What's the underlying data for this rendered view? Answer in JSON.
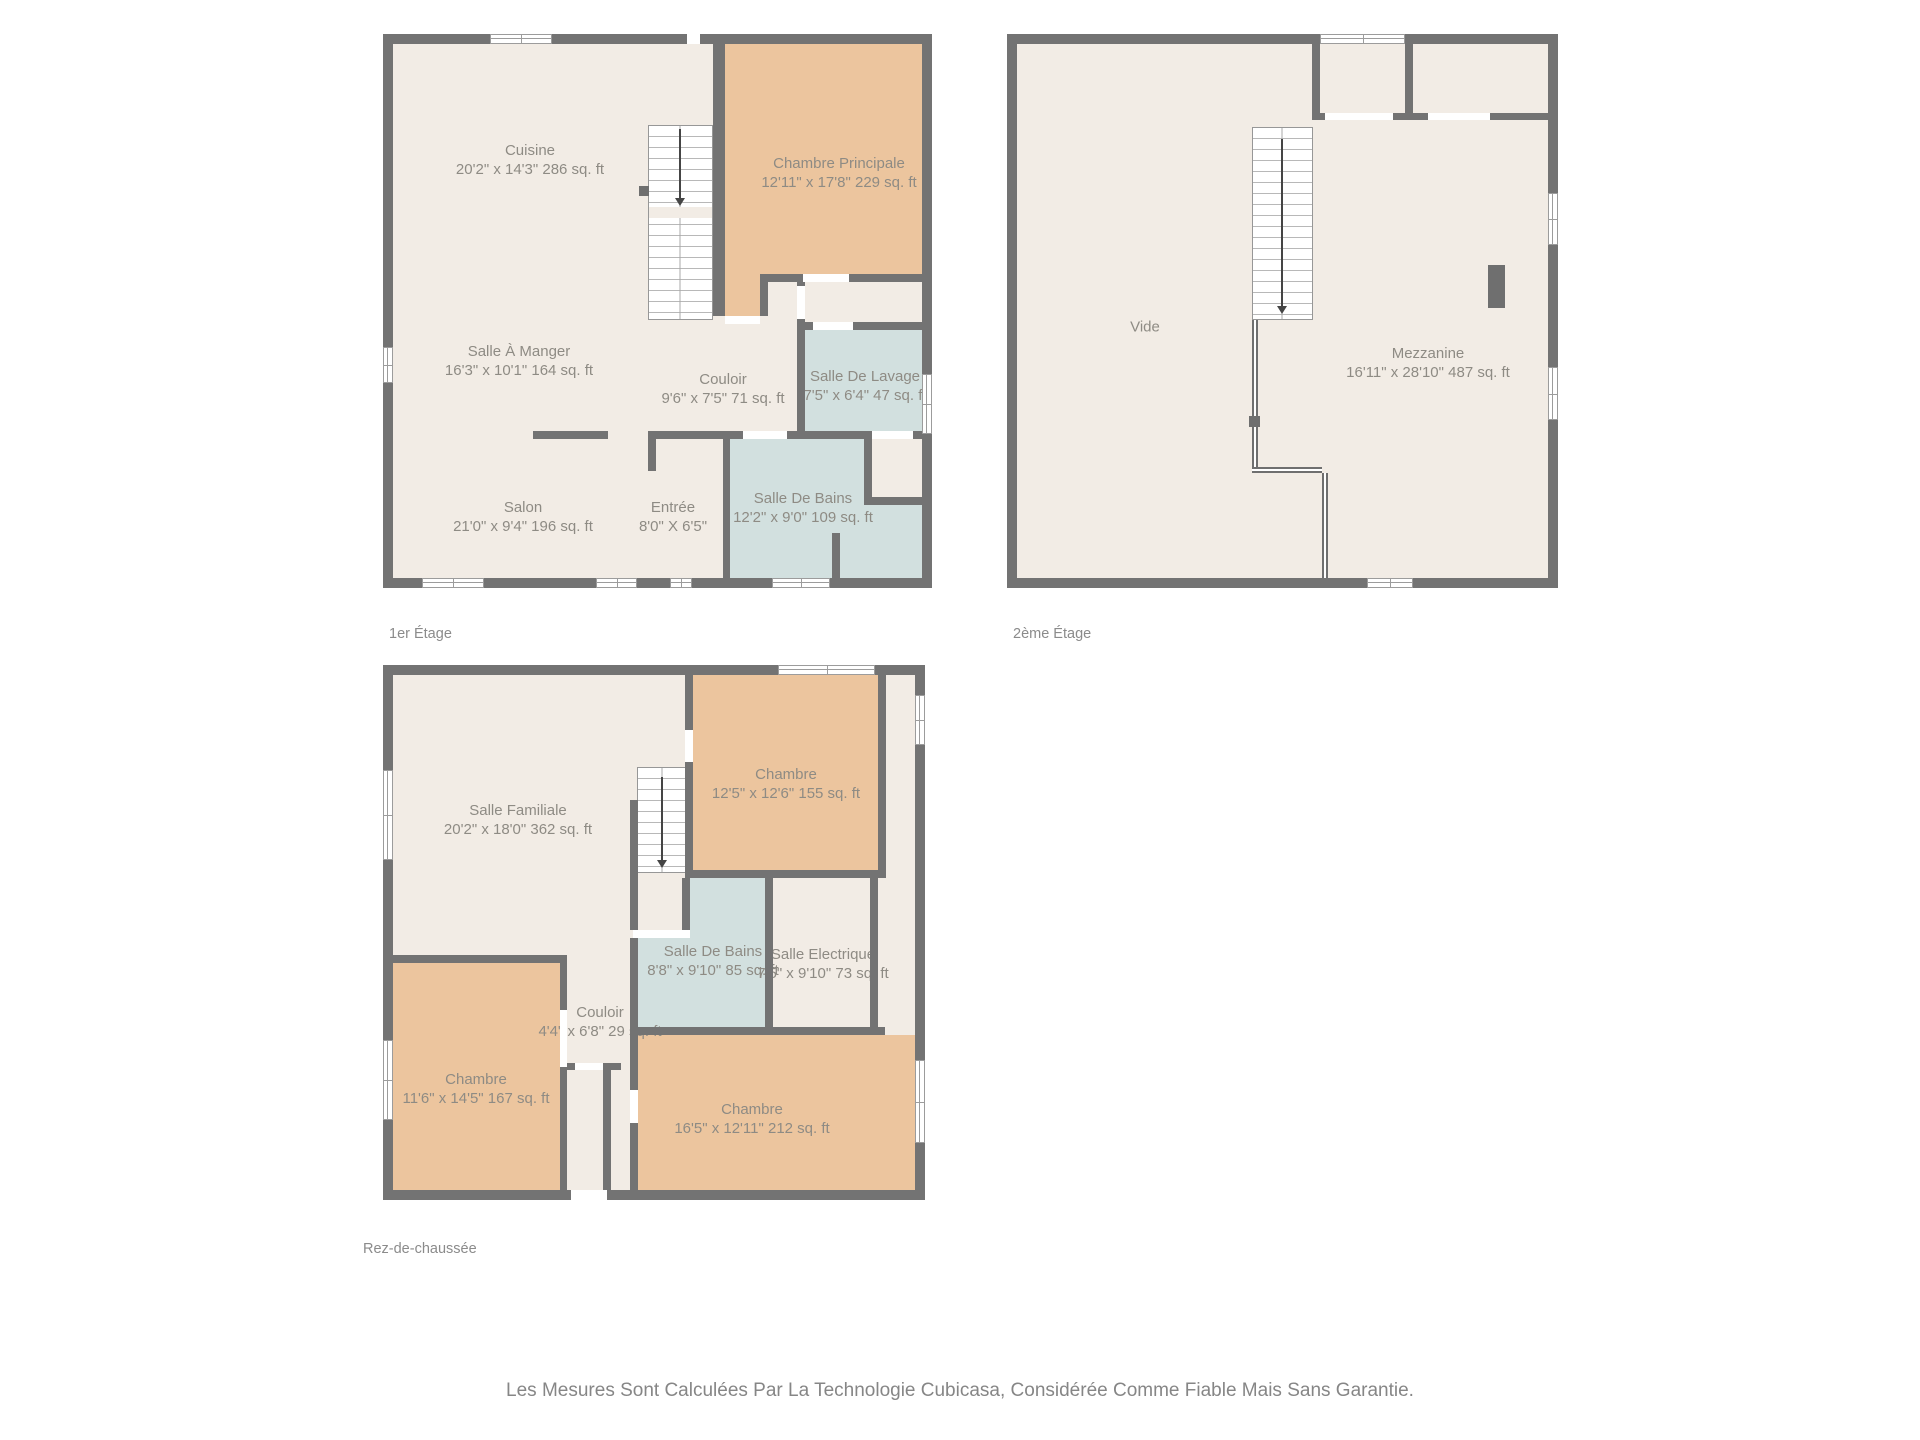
{
  "disclaimer": "Les Mesures Sont Calculées Par La Technologie Cubicasa, Considérée Comme Fiable Mais Sans Garantie.",
  "palette": {
    "wall": "#737373",
    "floor": "#f2ece5",
    "bedroom": "#ecc59e",
    "wet_room": "#d2e0df",
    "label_text": "#8e8b84",
    "title_text": "#8b8b8b"
  },
  "floors": [
    {
      "title": "1er Étage",
      "rooms": [
        {
          "name": "Cuisine",
          "dims": "20'2\" x 14'3\" 286 sq. ft"
        },
        {
          "name": "Chambre Principale",
          "dims": "12'11\" x 17'8\" 229 sq. ft"
        },
        {
          "name": "Salle À Manger",
          "dims": "16'3\" x 10'1\" 164 sq. ft"
        },
        {
          "name": "Couloir",
          "dims": "9'6\" x 7'5\" 71 sq. ft"
        },
        {
          "name": "Salle De Lavage",
          "dims": "7'5\" x 6'4\" 47 sq. ft"
        },
        {
          "name": "Salon",
          "dims": "21'0\" x 9'4\" 196 sq. ft"
        },
        {
          "name": "Entrée",
          "dims": "8'0\" X 6'5\""
        },
        {
          "name": "Salle De Bains",
          "dims": "12'2\" x 9'0\" 109 sq. ft"
        }
      ]
    },
    {
      "title": "2ème Étage",
      "rooms": [
        {
          "name": "Vide",
          "dims": ""
        },
        {
          "name": "Mezzanine",
          "dims": "16'11\" x 28'10\" 487 sq. ft"
        }
      ]
    },
    {
      "title": "Rez-de-chaussée",
      "rooms": [
        {
          "name": "Salle Familiale",
          "dims": "20'2\" x 18'0\" 362 sq. ft"
        },
        {
          "name": "Chambre",
          "dims": "12'5\" x 12'6\" 155 sq. ft"
        },
        {
          "name": "Salle De Bains",
          "dims": "8'8\" x 9'10\" 85 sq. ft"
        },
        {
          "name": "Salle Electrique",
          "dims": "7'5\" x 9'10\" 73 sq. ft"
        },
        {
          "name": "Couloir",
          "dims": "4'4\" x 6'8\" 29 sq. ft"
        },
        {
          "name": "Chambre",
          "dims": "11'6\" x 14'5\" 167 sq. ft"
        },
        {
          "name": "Chambre",
          "dims": "16'5\" x 12'11\" 212 sq. ft"
        }
      ]
    }
  ]
}
